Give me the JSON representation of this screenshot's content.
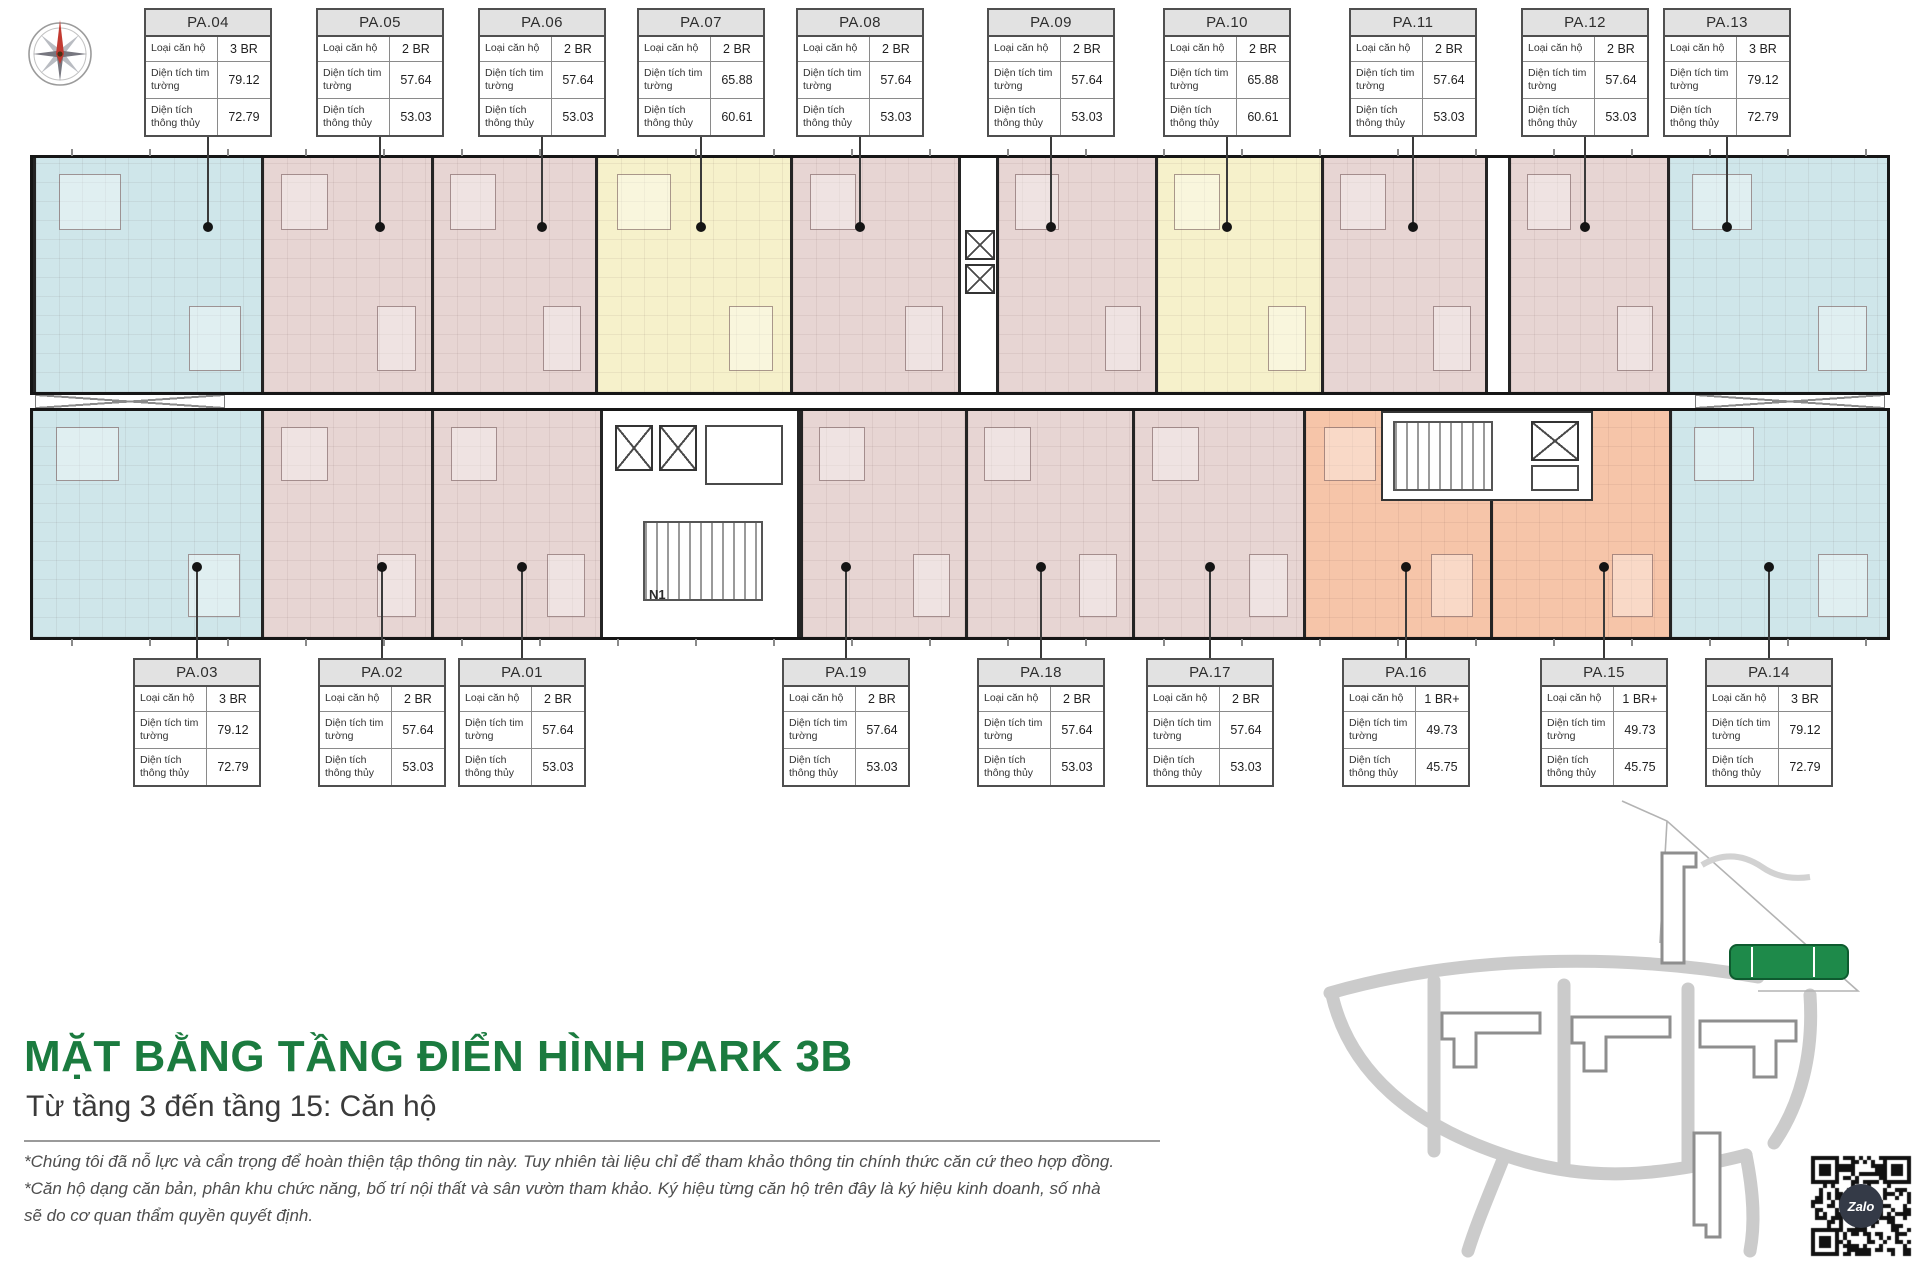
{
  "header": {
    "compass_icon": "compass-rose-north"
  },
  "unit_table_labels": {
    "unit_type": "Loại căn hộ",
    "area_gross": "Diện tích tim tường",
    "area_net": "Diện tích thông thủy"
  },
  "top_tables": [
    {
      "id": "PA.04",
      "type": "3 BR",
      "gross": "79.12",
      "net": "72.79"
    },
    {
      "id": "PA.05",
      "type": "2 BR",
      "gross": "57.64",
      "net": "53.03"
    },
    {
      "id": "PA.06",
      "type": "2 BR",
      "gross": "57.64",
      "net": "53.03"
    },
    {
      "id": "PA.07",
      "type": "2 BR",
      "gross": "65.88",
      "net": "60.61"
    },
    {
      "id": "PA.08",
      "type": "2 BR",
      "gross": "57.64",
      "net": "53.03"
    },
    {
      "id": "PA.09",
      "type": "2 BR",
      "gross": "57.64",
      "net": "53.03"
    },
    {
      "id": "PA.10",
      "type": "2 BR",
      "gross": "65.88",
      "net": "60.61"
    },
    {
      "id": "PA.11",
      "type": "2 BR",
      "gross": "57.64",
      "net": "53.03"
    },
    {
      "id": "PA.12",
      "type": "2 BR",
      "gross": "57.64",
      "net": "53.03"
    },
    {
      "id": "PA.13",
      "type": "3 BR",
      "gross": "79.12",
      "net": "72.79"
    }
  ],
  "bottom_tables": [
    {
      "id": "PA.03",
      "type": "3 BR",
      "gross": "79.12",
      "net": "72.79"
    },
    {
      "id": "PA.02",
      "type": "2 BR",
      "gross": "57.64",
      "net": "53.03"
    },
    {
      "id": "PA.01",
      "type": "2 BR",
      "gross": "57.64",
      "net": "53.03"
    },
    {
      "id": "PA.19",
      "type": "2 BR",
      "gross": "57.64",
      "net": "53.03"
    },
    {
      "id": "PA.18",
      "type": "2 BR",
      "gross": "57.64",
      "net": "53.03"
    },
    {
      "id": "PA.17",
      "type": "2 BR",
      "gross": "57.64",
      "net": "53.03"
    },
    {
      "id": "PA.16",
      "type": "1 BR+",
      "gross": "49.73",
      "net": "45.75"
    },
    {
      "id": "PA.15",
      "type": "1 BR+",
      "gross": "49.73",
      "net": "45.75"
    },
    {
      "id": "PA.14",
      "type": "3 BR",
      "gross": "79.12",
      "net": "72.79"
    }
  ],
  "plan": {
    "core_label": "N1",
    "unit_colors": {
      "three_br_blue": "#CFE6EA",
      "two_br_pink": "#E7D5D3",
      "two_br_yellow": "#F6F1CB",
      "one_br_plus_orange": "#F6C5A9"
    }
  },
  "title_block": {
    "title": "MẶT BẰNG TẦNG ĐIỂN HÌNH PARK 3B",
    "subtitle": "Từ tầng 3 đến tầng 15: Căn hộ",
    "title_color": "#1B7B3F"
  },
  "footnotes": {
    "line1": "*Chúng tôi đã nỗ lực và cẩn trọng để hoàn thiện tập thông tin này. Tuy nhiên tài liệu chỉ để tham khảo thông tin chính thức căn cứ theo hợp đồng.",
    "line2": "*Căn hộ dạng căn bản, phân khu chức năng, bố trí nội thất và sân vườn tham khảo. Ký hiệu từng căn hộ trên đây là ký hiệu kinh doanh, số nhà",
    "line3": "sẽ do cơ quan thẩm quyền quyết định."
  },
  "site_map": {
    "highlight_color": "#1E8A4A"
  },
  "qr": {
    "label": "Zalo"
  }
}
